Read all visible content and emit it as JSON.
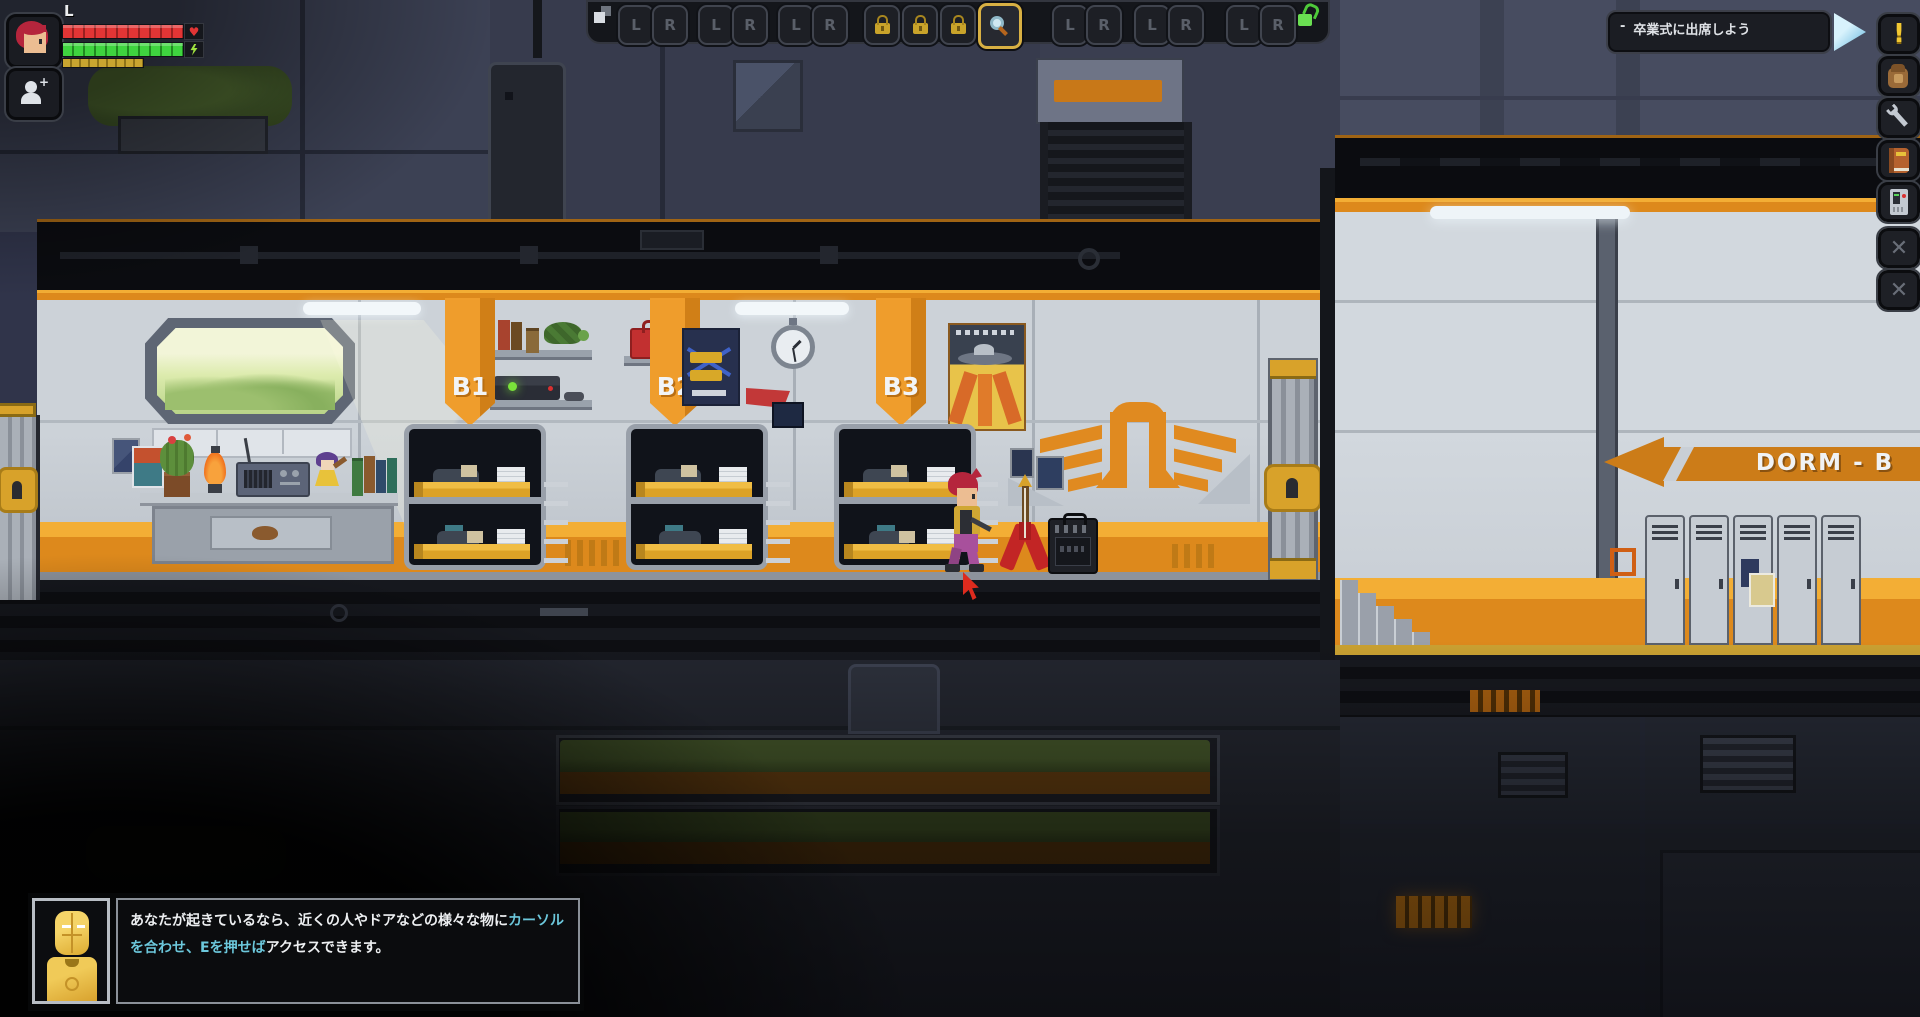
{
  "hud": {
    "player_status": {
      "level_label": "L",
      "health_icon": "♥"
    },
    "hotbar": {
      "pairs": [
        {
          "l": "L",
          "r": "R"
        },
        {
          "l": "L",
          "r": "R"
        },
        {
          "l": "L",
          "r": "R"
        },
        {
          "l": "L",
          "r": "R"
        },
        {
          "l": "L",
          "r": "R"
        },
        {
          "l": "L",
          "r": "R"
        }
      ]
    },
    "quest_tracker": {
      "bullet": "-",
      "text": "卒業式に出席しよう"
    },
    "side_toolbar": {
      "quests_glyph": "!",
      "close_glyph_1": "✕",
      "close_glyph_2": "✕"
    }
  },
  "scene": {
    "bunk_labels": [
      "B1",
      "B2",
      "B3"
    ],
    "dorm_sign": "DORM - B"
  },
  "dialog": {
    "part1": "あなたが起きているなら、近くの人やドアなどの様々な物に",
    "highlight": "カーソルを合わせ、Eを押せば",
    "part2": "アクセスできます。"
  },
  "colors": {
    "accent_orange": "#e8951f",
    "highlight_cyan": "#6cc8dc",
    "health_red": "#e23535",
    "energy_green": "#3fd43f",
    "food_gold": "#c9a530",
    "quest_yellow": "#f2c832"
  }
}
